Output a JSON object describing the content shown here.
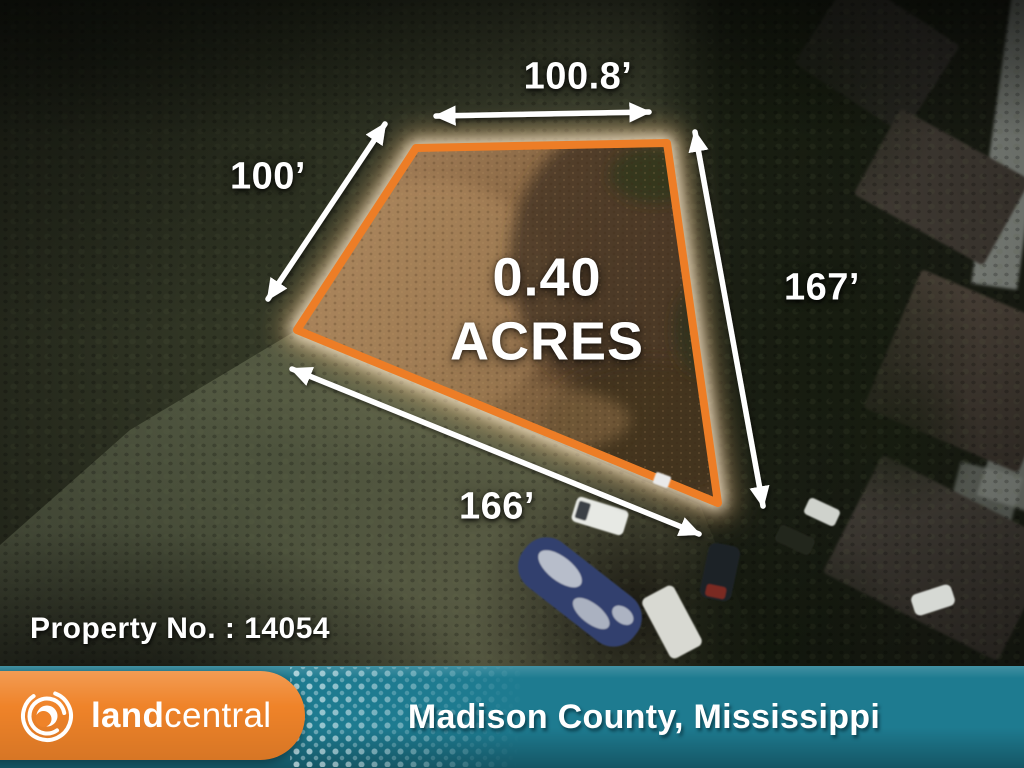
{
  "map": {
    "acreage": {
      "value": "0.40",
      "unit": "ACRES"
    },
    "dimensions": {
      "top": "100.8’",
      "left": "100’",
      "right": "167’",
      "bottom": "166’"
    },
    "property_number_label": "Property No. : 14054"
  },
  "footer": {
    "brand": {
      "land": "land",
      "central": "central"
    },
    "location": "Madison County, Mississippi"
  },
  "icons": {
    "brand_logo": "landcentral-swirl-icon"
  },
  "colors": {
    "lot_outline": "#ED7D26",
    "brand_orange": "#EF8329",
    "footer_teal": "#1E7B90",
    "text_white": "#FFFFFF"
  }
}
